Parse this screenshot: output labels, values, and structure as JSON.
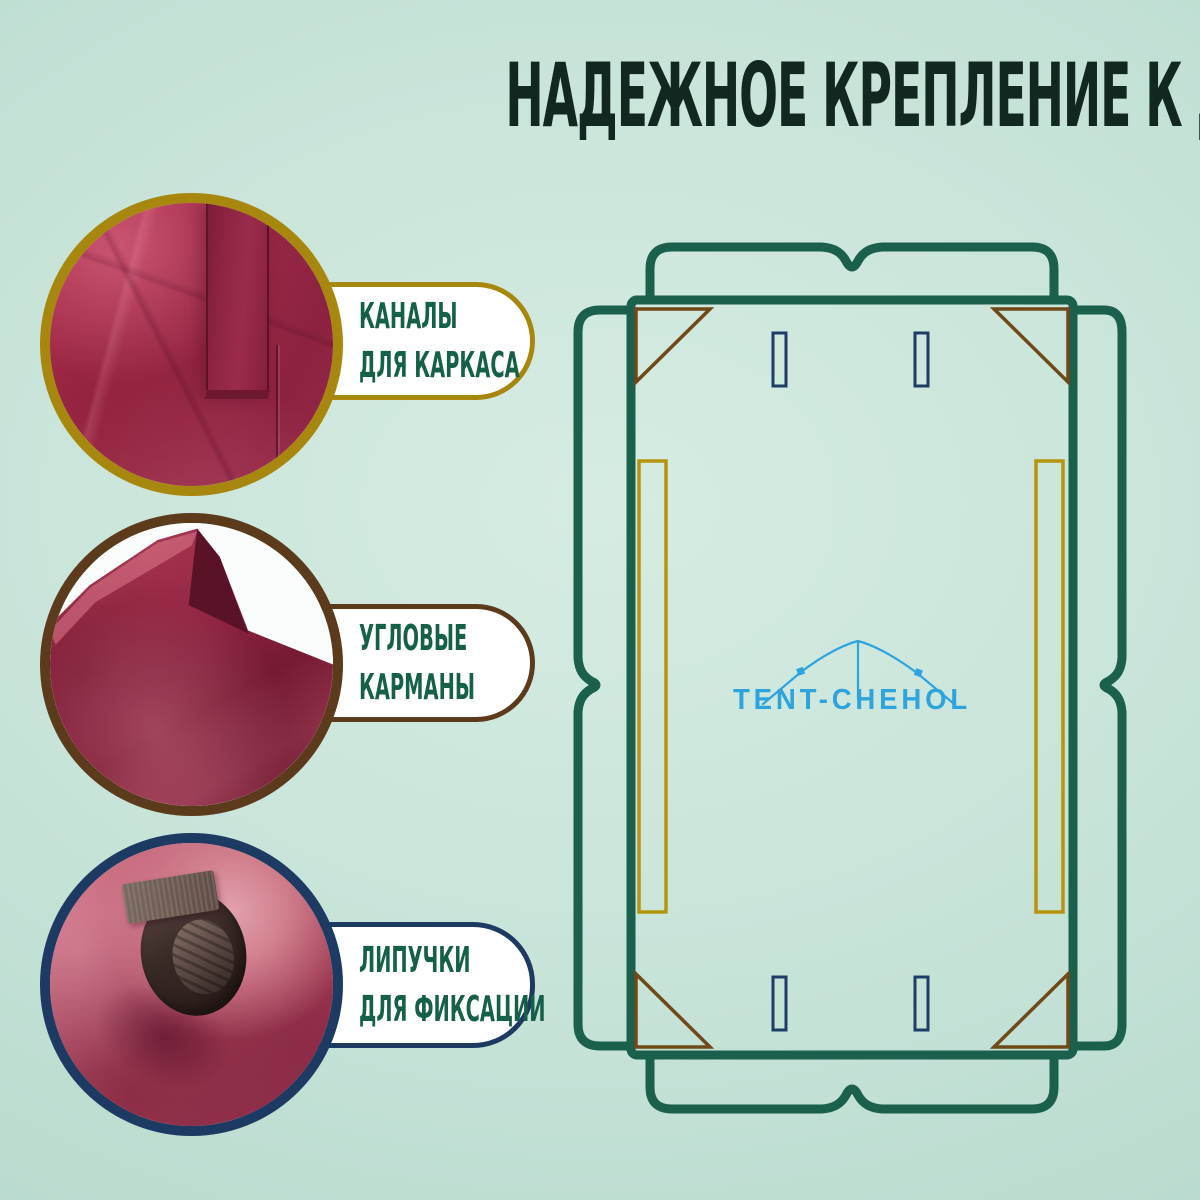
{
  "title": "НАДЕЖНОЕ КРЕПЛЕНИЕ К ДУГАМ КРЫШИ",
  "callouts": [
    {
      "id": "frame-channels",
      "line1": "КАНАЛЫ",
      "line2": "ДЛЯ КАРКАСА",
      "accent_color": "#a8870f"
    },
    {
      "id": "corner-pockets",
      "line1": "УГЛОВЫЕ",
      "line2": "КАРМАНЫ",
      "accent_color": "#5c3b1d"
    },
    {
      "id": "velcro-straps",
      "line1": "ЛИПУЧКИ",
      "line2": "ДЛЯ ФИКСАЦИИ",
      "accent_color": "#1d3a63"
    }
  ],
  "diagram": {
    "logo": "TENT-CHEHOL",
    "logo_icon": "tent-icon",
    "outline_color": "#1b604d",
    "corner_pocket_color": "#6f4917",
    "frame_channel_color": "#b6940e",
    "velcro_slot_color": "#1e3d66",
    "logo_color": "#2ea4df"
  },
  "colors": {
    "background": "#c2e0d5",
    "title_text": "#12271f",
    "label_text": "#156049",
    "fabric_burgundy": "#952744"
  }
}
